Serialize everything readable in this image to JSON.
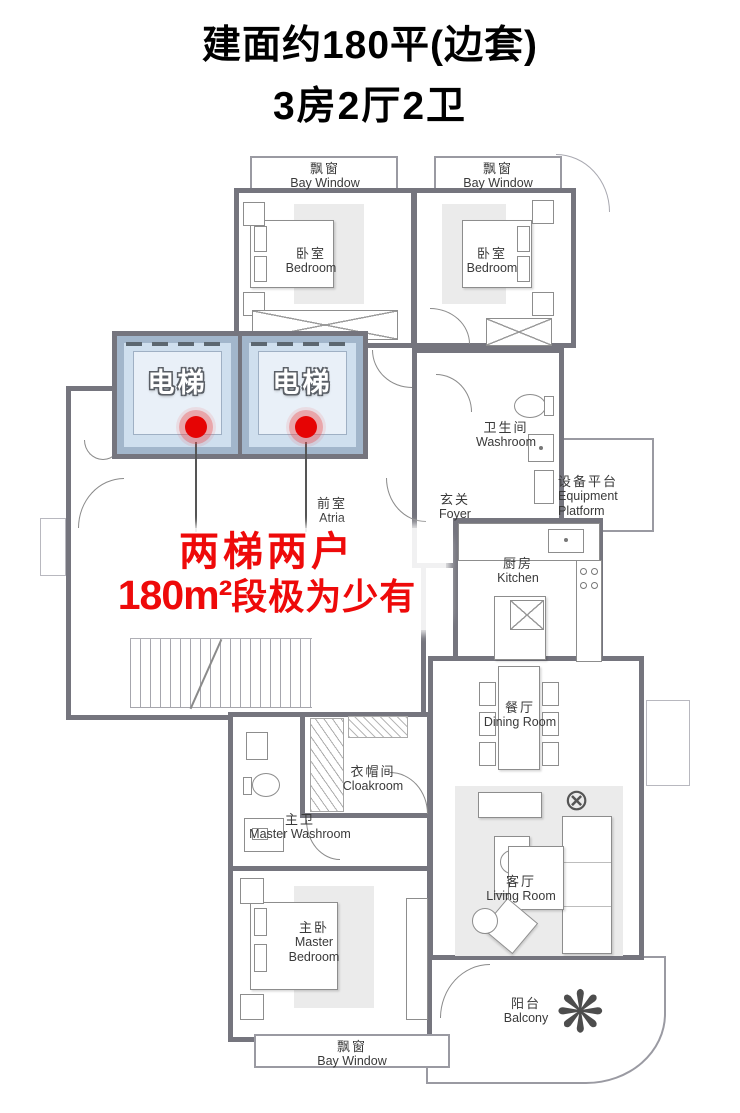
{
  "title": {
    "line1": "建面约180平(边套)",
    "line2": "3房2厅2卫"
  },
  "overlay": {
    "line1": "两梯两户",
    "line2_num": "180m²",
    "line2_rest": "段极为少有"
  },
  "elevators": [
    {
      "label": "电梯"
    },
    {
      "label": "电梯"
    }
  ],
  "rooms": {
    "bay_window_top_left": {
      "zh": "飘窗",
      "en": "Bay Window"
    },
    "bay_window_top_right": {
      "zh": "飘窗",
      "en": "Bay Window"
    },
    "bay_window_bottom": {
      "zh": "飘窗",
      "en": "Bay Window"
    },
    "bedroom_left": {
      "zh": "卧室",
      "en": "Bedroom"
    },
    "bedroom_right": {
      "zh": "卧室",
      "en": "Bedroom"
    },
    "atria": {
      "zh": "前室",
      "en": "Atria"
    },
    "foyer": {
      "zh": "玄关",
      "en": "Foyer"
    },
    "washroom": {
      "zh": "卫生间",
      "en": "Washroom"
    },
    "equipment_platform": {
      "zh": "设备平台",
      "en": "Equipment Platform"
    },
    "kitchen": {
      "zh": "厨房",
      "en": "Kitchen"
    },
    "dining_room": {
      "zh": "餐厅",
      "en": "Dining Room"
    },
    "cloakroom": {
      "zh": "衣帽间",
      "en": "Cloakroom"
    },
    "master_washroom": {
      "zh": "主卫",
      "en": "Master Washroom"
    },
    "master_bedroom": {
      "zh": "主卧",
      "en": "Master Bedroom"
    },
    "living_room": {
      "zh": "客厅",
      "en": "Living Room"
    },
    "balcony": {
      "zh": "阳台",
      "en": "Balcony"
    }
  },
  "icons": {
    "plant": "❋",
    "side_table": "⊗"
  },
  "colors": {
    "wall": "#75757e",
    "accent_red": "#ee0a0a",
    "elevator_fill": "#cfdfee",
    "elevator_border": "#a2b6cb"
  }
}
